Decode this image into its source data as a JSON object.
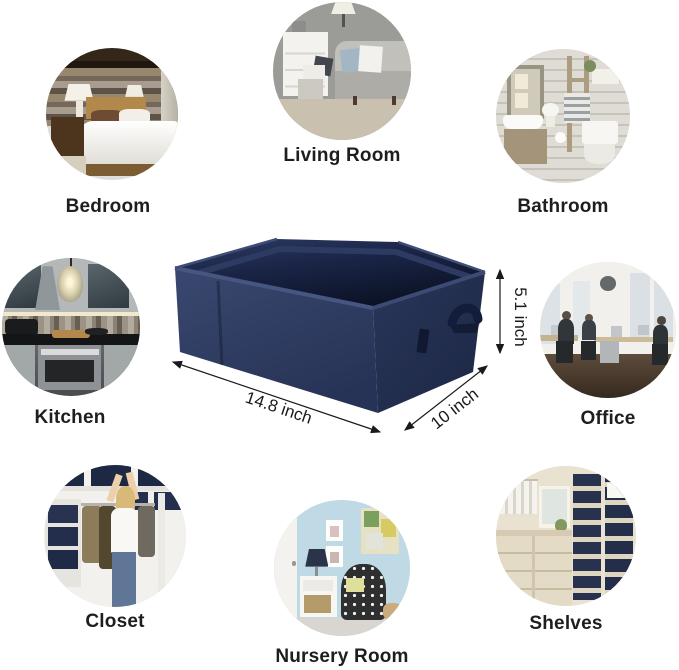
{
  "rooms": [
    {
      "id": "bedroom",
      "label": "Bedroom"
    },
    {
      "id": "living-room",
      "label": "Living Room"
    },
    {
      "id": "bathroom",
      "label": "Bathroom"
    },
    {
      "id": "kitchen",
      "label": "Kitchen"
    },
    {
      "id": "office",
      "label": "Office"
    },
    {
      "id": "closet",
      "label": "Closet"
    },
    {
      "id": "nursery-room",
      "label": "Nursery Room"
    },
    {
      "id": "shelves",
      "label": "Shelves"
    }
  ],
  "basket": {
    "dimensions": {
      "width": "14.8 inch",
      "depth": "10 inch",
      "height": "5.1 inch"
    },
    "colors": {
      "fabric_front": "#32406a",
      "fabric_side": "#1f2947",
      "interior": "#0c1226",
      "rim_highlight": "#475581",
      "annotation": "#1a1a1a"
    }
  }
}
